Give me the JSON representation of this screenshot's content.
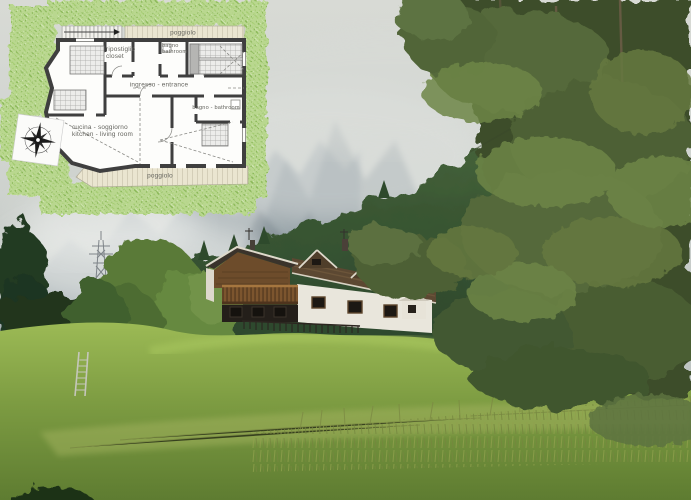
{
  "floor_plan": {
    "balcony_top": "poggiolo",
    "balcony_bottom": "poggiolo",
    "closet_it": "ripostiglio",
    "closet_en": "closet",
    "bath_top_it": "bagno",
    "bath_top_en": "bathroom",
    "entrance": "ingresso - entrance",
    "bath_right": "bagno - bathroom",
    "living_it": "cucina - soggiorno",
    "living_en": "kitchen - living room"
  },
  "scene": {
    "colors": {
      "sky": "#d3d6d1",
      "mountain_haze": "#8794a0",
      "forest_ridge": "#2f4a2e",
      "larch_green": "#52663a",
      "meadow_light": "#9cba55",
      "meadow_dark": "#5e7c31",
      "house_wall": "#e9e6dc",
      "house_wood": "#6d4c2b",
      "house_roof": "#5c4832",
      "plan_wall": "#3f3f3f",
      "plan_balcony": "#eae5d0",
      "plan_greenery": "#b9d78f",
      "plan_text": "#63635d"
    }
  }
}
